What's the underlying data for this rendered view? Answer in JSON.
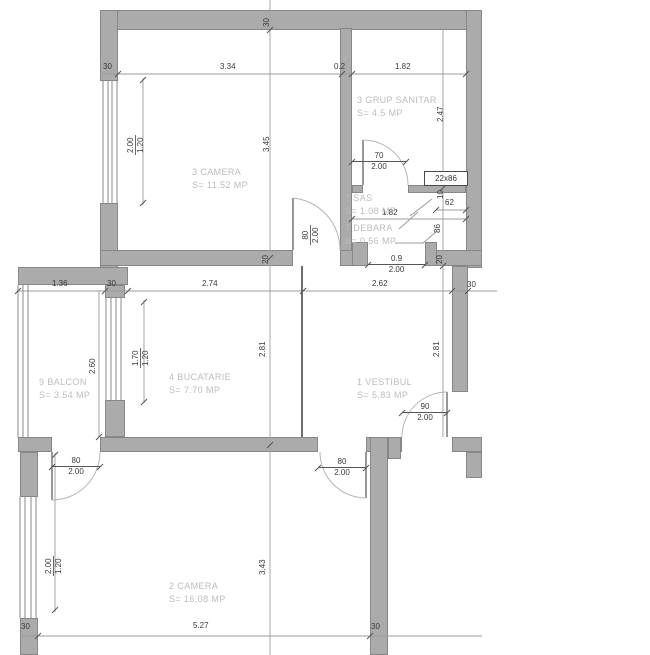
{
  "rooms": [
    {
      "name": "3 CAMERA",
      "area": "S= 11.52 MP"
    },
    {
      "name": "3 GRUP SANITAR",
      "area": "S= 4.5 MP"
    },
    {
      "name": "7 SAS",
      "area": "S= 1.08 MP"
    },
    {
      "name": "7 DEBARA",
      "area": "S= 0.56 MP"
    },
    {
      "name": "9 BALCON",
      "area": "S= 3.54 MP"
    },
    {
      "name": "4 BUCATARIE",
      "area": "S= 7.70 MP"
    },
    {
      "name": "1 VESTIBUL",
      "area": "S= 5.83 MP"
    },
    {
      "name": "2 CAMERA",
      "area": "S= 16.08 MP"
    }
  ],
  "values": {
    "v30": "30",
    "v20": "20",
    "v10": "10",
    "v334": "3.34",
    "v02": "0.2",
    "v182": "1.82",
    "v136": "1.36",
    "v274": "2.74",
    "v262": "2.62",
    "v527": "5.27",
    "v345": "3.45",
    "v247": "2.47",
    "v281": "2.81",
    "v260": "2.60",
    "v343": "3.43",
    "v62": "62",
    "v86": "86",
    "v2286": "22x86",
    "v200": "2.00",
    "v120": "1.20",
    "v170": "1.70",
    "v70": "70",
    "v09": "0.9",
    "v80": "80",
    "v90": "90"
  },
  "colors": {
    "wall_fill": "#ababab",
    "wall_edge": "#878787",
    "dim_text": "#3a3a3a",
    "room_text": "#bcbcbc"
  }
}
